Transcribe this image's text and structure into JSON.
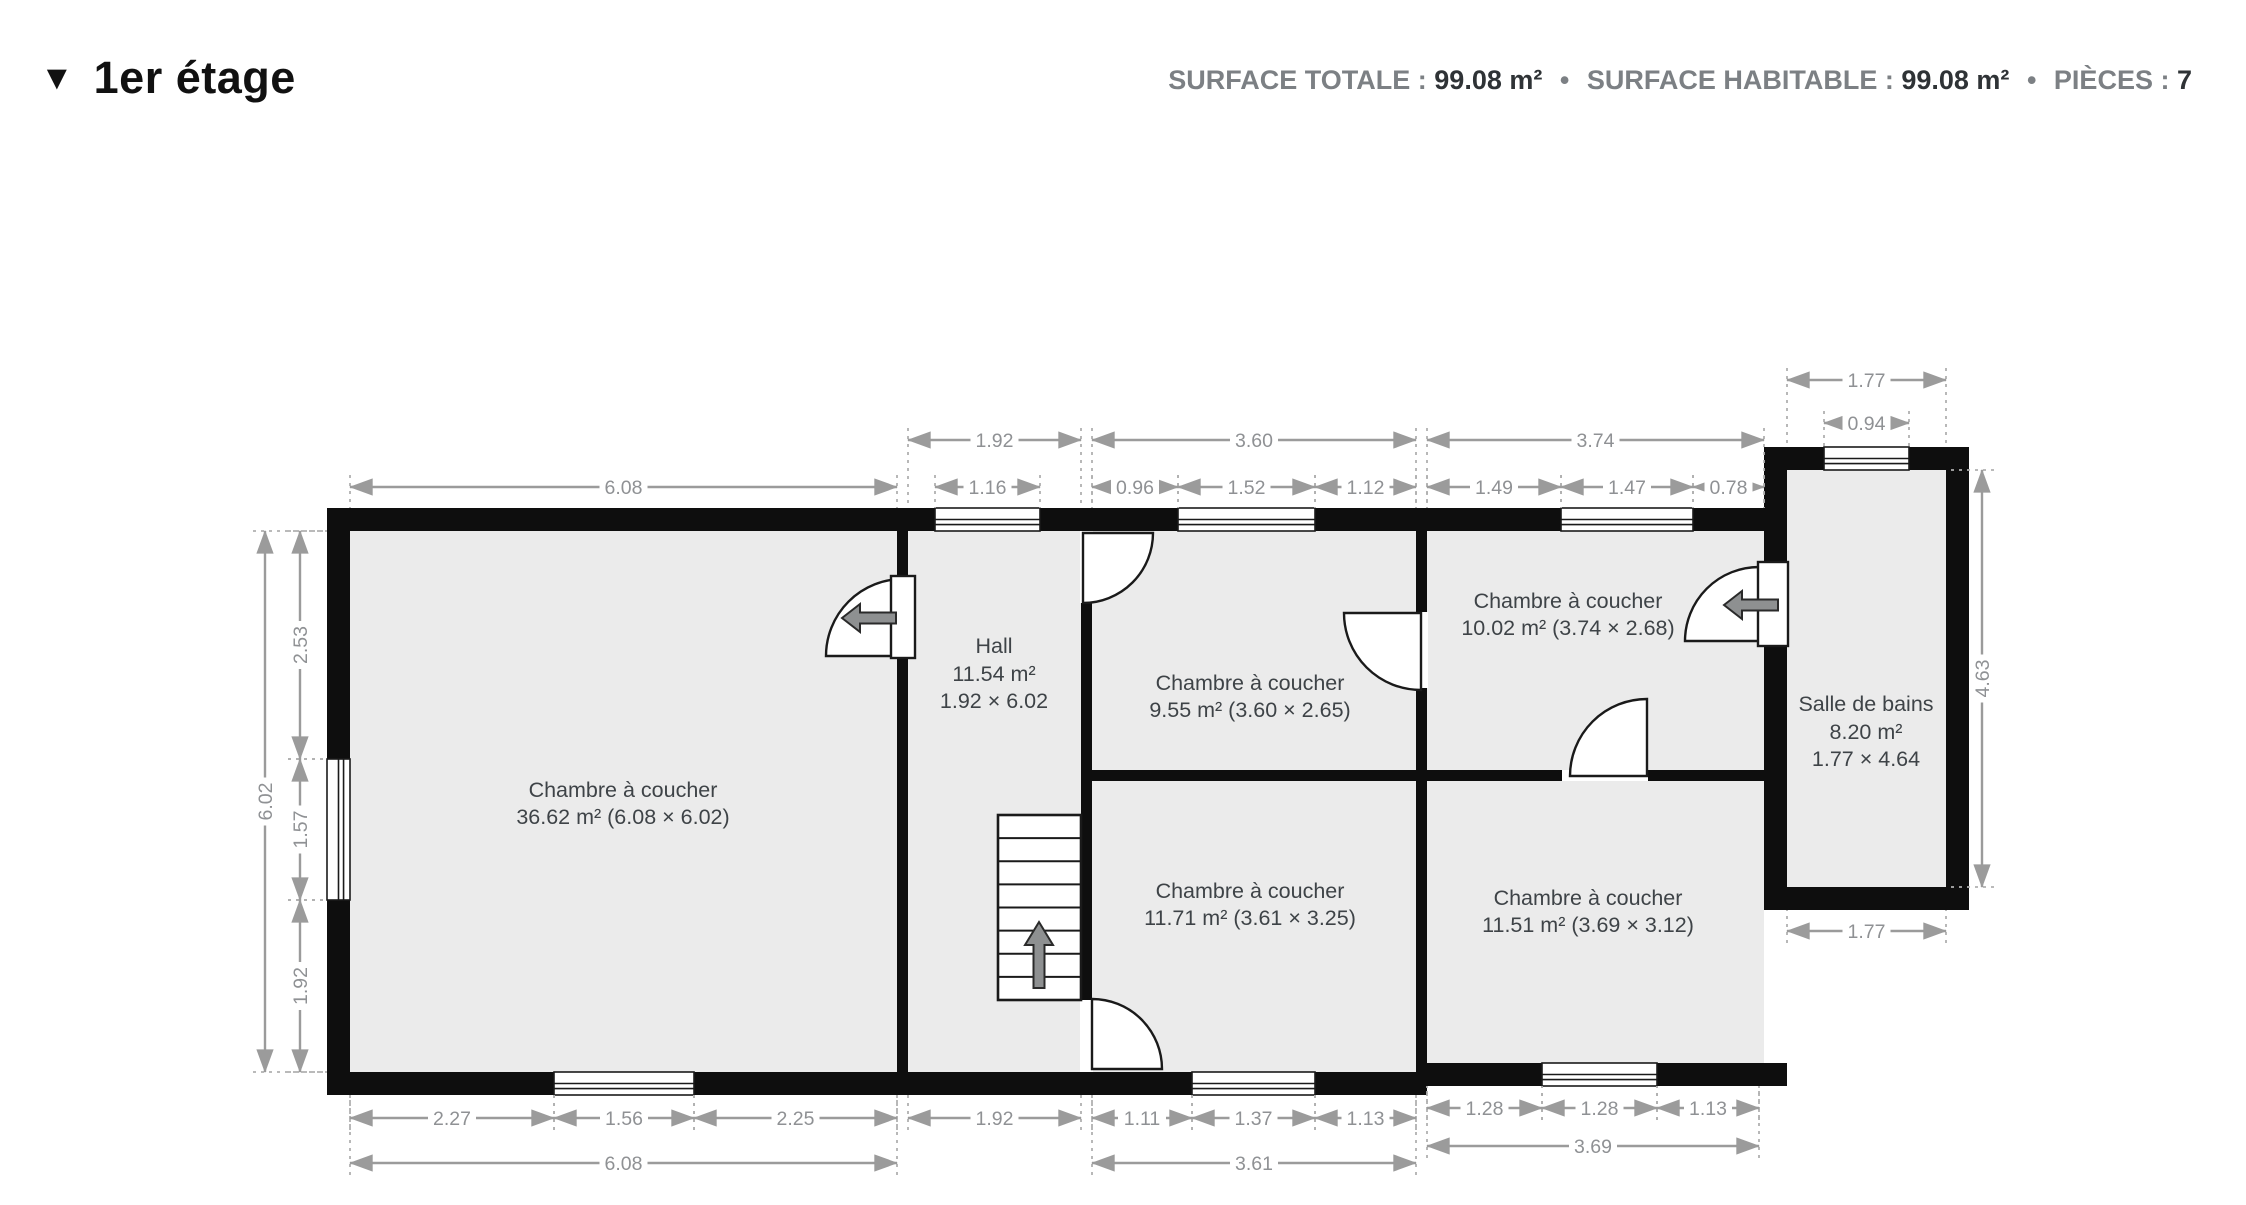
{
  "header": {
    "collapse_icon": "▼",
    "title": "1er étage",
    "separator": "•",
    "stats": [
      {
        "label": "SURFACE TOTALE :",
        "value": "99.08 m²"
      },
      {
        "label": "SURFACE HABITABLE :",
        "value": "99.08 m²"
      },
      {
        "label": "PIÈCES :",
        "value": "7"
      }
    ]
  },
  "colors": {
    "wall": "#0e0e0e",
    "floor": "#ebebeb",
    "dim_line": "#9b9b9b",
    "dim_text": "#8f9194",
    "ext_line": "#b0b0b0",
    "room_text": "#3e4347",
    "arrow_fill": "#8e9091",
    "arrow_stroke": "#2a2a2a",
    "door_stroke": "#1a1a1a"
  },
  "plan": {
    "floors": [
      [
        350,
        531,
        547,
        541
      ],
      [
        908,
        531,
        173,
        541
      ],
      [
        1092,
        531,
        324,
        541
      ],
      [
        1427,
        531,
        337,
        532
      ],
      [
        1787,
        470,
        159,
        417
      ]
    ],
    "walls": [
      [
        327,
        508,
        1437,
        23
      ],
      [
        1764,
        447,
        205,
        23
      ],
      [
        327,
        508,
        23,
        587
      ],
      [
        327,
        1072,
        1100,
        23
      ],
      [
        1416,
        1063,
        371,
        23
      ],
      [
        1946,
        447,
        23,
        463
      ],
      [
        1764,
        887,
        205,
        23
      ],
      [
        1764,
        447,
        23,
        463
      ],
      [
        897,
        531,
        11,
        541
      ],
      [
        1081,
        531,
        11,
        541
      ],
      [
        1416,
        531,
        11,
        541
      ],
      [
        1092,
        770,
        324,
        11
      ],
      [
        1427,
        770,
        337,
        11
      ]
    ],
    "windows": [
      {
        "x": 935,
        "y": 508,
        "w": 105,
        "h": 23,
        "o": "h"
      },
      {
        "x": 1178,
        "y": 508,
        "w": 137,
        "h": 23,
        "o": "h"
      },
      {
        "x": 1561,
        "y": 508,
        "w": 132,
        "h": 23,
        "o": "h"
      },
      {
        "x": 1824,
        "y": 447,
        "w": 85,
        "h": 23,
        "o": "h"
      },
      {
        "x": 327,
        "y": 759,
        "w": 23,
        "h": 141,
        "o": "v"
      },
      {
        "x": 554,
        "y": 1072,
        "w": 140,
        "h": 23,
        "o": "h"
      },
      {
        "x": 1192,
        "y": 1072,
        "w": 123,
        "h": 23,
        "o": "h"
      },
      {
        "x": 1542,
        "y": 1063,
        "w": 115,
        "h": 23,
        "o": "h"
      }
    ],
    "door_gaps": [
      [
        897,
        578,
        11,
        80
      ],
      [
        1081,
        531,
        11,
        72
      ],
      [
        1416,
        612,
        11,
        76
      ],
      [
        1563,
        770,
        84,
        11
      ],
      [
        1081,
        1000,
        11,
        72
      ],
      [
        1764,
        566,
        23,
        78
      ]
    ],
    "door_sectors": [
      {
        "cx": 903,
        "cy": 656,
        "r": 77,
        "sx": 903,
        "sy": 579,
        "ex": 826,
        "ey": 656,
        "sw": 0
      },
      {
        "cx": 1083,
        "cy": 533,
        "r": 70,
        "sx": 1153,
        "sy": 533,
        "ex": 1083,
        "ey": 603,
        "sw": 1
      },
      {
        "cx": 1421,
        "cy": 613,
        "r": 77,
        "sx": 1344,
        "sy": 613,
        "ex": 1421,
        "ey": 690,
        "sw": 0
      },
      {
        "cx": 1647,
        "cy": 776,
        "r": 77,
        "sx": 1647,
        "sy": 699,
        "ex": 1570,
        "ey": 776,
        "sw": 0
      },
      {
        "cx": 1759,
        "cy": 641,
        "r": 74,
        "sx": 1759,
        "sy": 567,
        "ex": 1685,
        "ey": 641,
        "sw": 0
      },
      {
        "cx": 1092,
        "cy": 1069,
        "r": 70,
        "sx": 1092,
        "sy": 999,
        "ex": 1162,
        "ey": 1069,
        "sw": 1
      }
    ],
    "door_panels": [
      [
        891,
        576,
        24,
        82
      ],
      [
        1758,
        562,
        30,
        84
      ]
    ],
    "entry_arrows": [
      {
        "cx": 870,
        "cy": 618
      },
      {
        "cx": 1752,
        "cy": 605
      }
    ],
    "stairs": {
      "x": 998,
      "y": 815,
      "w": 83,
      "h": 185,
      "treads": 7,
      "arrow": {
        "cx": 1039,
        "cy": 955
      }
    },
    "rooms": [
      {
        "lines": [
          "Chambre à coucher",
          "36.62 m² (6.08 × 6.02)"
        ],
        "x": 623,
        "ys": [
          797,
          824
        ]
      },
      {
        "lines": [
          "Hall",
          "11.54 m²",
          "1.92 × 6.02"
        ],
        "x": 994,
        "ys": [
          653,
          681,
          708
        ]
      },
      {
        "lines": [
          "Chambre à coucher",
          "9.55 m² (3.60 × 2.65)"
        ],
        "x": 1250,
        "ys": [
          690,
          717
        ]
      },
      {
        "lines": [
          "Chambre à coucher",
          "10.02 m² (3.74 × 2.68)"
        ],
        "x": 1568,
        "ys": [
          608,
          635
        ]
      },
      {
        "lines": [
          "Salle de bains",
          "8.20 m²",
          "1.77 × 4.64"
        ],
        "x": 1866,
        "ys": [
          711,
          739,
          766
        ]
      },
      {
        "lines": [
          "Chambre à coucher",
          "11.71 m² (3.61 × 3.25)"
        ],
        "x": 1250,
        "ys": [
          898,
          925
        ]
      },
      {
        "lines": [
          "Chambre à coucher",
          "11.51 m² (3.69 × 3.12)"
        ],
        "x": 1588,
        "ys": [
          905,
          932
        ]
      }
    ],
    "dims": [
      {
        "t": "1.92",
        "o": "h",
        "a": 908,
        "b": 1081,
        "p": 440,
        "s": 1,
        "e": 68
      },
      {
        "t": "3.60",
        "o": "h",
        "a": 1092,
        "b": 1416,
        "p": 440,
        "s": 1,
        "e": 68
      },
      {
        "t": "3.74",
        "o": "h",
        "a": 1427,
        "b": 1764,
        "p": 440,
        "s": 1,
        "e": 68
      },
      {
        "t": "1.77",
        "o": "h",
        "a": 1787,
        "b": 1946,
        "p": 380,
        "s": 1,
        "e": 67
      },
      {
        "t": "0.94",
        "o": "h",
        "a": 1824,
        "b": 1909,
        "p": 423,
        "s": 1,
        "e": 24
      },
      {
        "t": "6.08",
        "o": "h",
        "a": 350,
        "b": 897,
        "p": 487,
        "s": 1,
        "e": 21
      },
      {
        "t": "1.16",
        "o": "h",
        "a": 935,
        "b": 1040,
        "p": 487,
        "s": 1,
        "e": 21
      },
      {
        "t": "0.96",
        "o": "h",
        "a": 1092,
        "b": 1178,
        "p": 487,
        "s": 1,
        "e": 21
      },
      {
        "t": "1.52",
        "o": "h",
        "a": 1178,
        "b": 1315,
        "p": 487,
        "s": 1,
        "e": 21
      },
      {
        "t": "1.12",
        "o": "h",
        "a": 1315,
        "b": 1416,
        "p": 487,
        "s": 1,
        "e": 21
      },
      {
        "t": "1.49",
        "o": "h",
        "a": 1427,
        "b": 1561,
        "p": 487,
        "s": 1,
        "e": 21
      },
      {
        "t": "1.47",
        "o": "h",
        "a": 1561,
        "b": 1693,
        "p": 487,
        "s": 1,
        "e": 21
      },
      {
        "t": "0.78",
        "o": "h",
        "a": 1693,
        "b": 1764,
        "p": 487,
        "s": 1,
        "e": 21
      },
      {
        "t": "2.27",
        "o": "h",
        "a": 350,
        "b": 554,
        "p": 1118,
        "s": -1,
        "e": 23
      },
      {
        "t": "1.56",
        "o": "h",
        "a": 554,
        "b": 694,
        "p": 1118,
        "s": -1,
        "e": 23
      },
      {
        "t": "2.25",
        "o": "h",
        "a": 694,
        "b": 897,
        "p": 1118,
        "s": -1,
        "e": 23
      },
      {
        "t": "1.92",
        "o": "h",
        "a": 908,
        "b": 1081,
        "p": 1118,
        "s": -1,
        "e": 23
      },
      {
        "t": "1.11",
        "o": "h",
        "a": 1092,
        "b": 1192,
        "p": 1118,
        "s": -1,
        "e": 23
      },
      {
        "t": "1.37",
        "o": "h",
        "a": 1192,
        "b": 1315,
        "p": 1118,
        "s": -1,
        "e": 23
      },
      {
        "t": "1.13",
        "o": "h",
        "a": 1315,
        "b": 1416,
        "p": 1118,
        "s": -1,
        "e": 23
      },
      {
        "t": "1.28",
        "o": "h",
        "a": 1427,
        "b": 1542,
        "p": 1108,
        "s": -1,
        "e": 22
      },
      {
        "t": "1.28",
        "o": "h",
        "a": 1542,
        "b": 1657,
        "p": 1108,
        "s": -1,
        "e": 22
      },
      {
        "t": "1.13",
        "o": "h",
        "a": 1657,
        "b": 1759,
        "p": 1108,
        "s": -1,
        "e": 22
      },
      {
        "t": "6.08",
        "o": "h",
        "a": 350,
        "b": 897,
        "p": 1163,
        "s": -1,
        "e": 68
      },
      {
        "t": "3.61",
        "o": "h",
        "a": 1092,
        "b": 1416,
        "p": 1163,
        "s": -1,
        "e": 68
      },
      {
        "t": "3.69",
        "o": "h",
        "a": 1427,
        "b": 1759,
        "p": 1146,
        "s": -1,
        "e": 60
      },
      {
        "t": "1.77",
        "o": "h",
        "a": 1787,
        "b": 1946,
        "p": 931,
        "s": -1,
        "e": 21
      },
      {
        "t": "6.02",
        "o": "v",
        "a": 531,
        "b": 1072,
        "p": 265,
        "s": 1,
        "e": 62
      },
      {
        "t": "2.53",
        "o": "v",
        "a": 531,
        "b": 759,
        "p": 300,
        "s": 1,
        "e": 27
      },
      {
        "t": "1.57",
        "o": "v",
        "a": 759,
        "b": 900,
        "p": 300,
        "s": 1,
        "e": 27
      },
      {
        "t": "1.92",
        "o": "v",
        "a": 900,
        "b": 1072,
        "p": 300,
        "s": 1,
        "e": 27
      },
      {
        "t": "4.63",
        "o": "v",
        "a": 470,
        "b": 887,
        "p": 1982,
        "s": -1,
        "e": 36
      }
    ]
  }
}
